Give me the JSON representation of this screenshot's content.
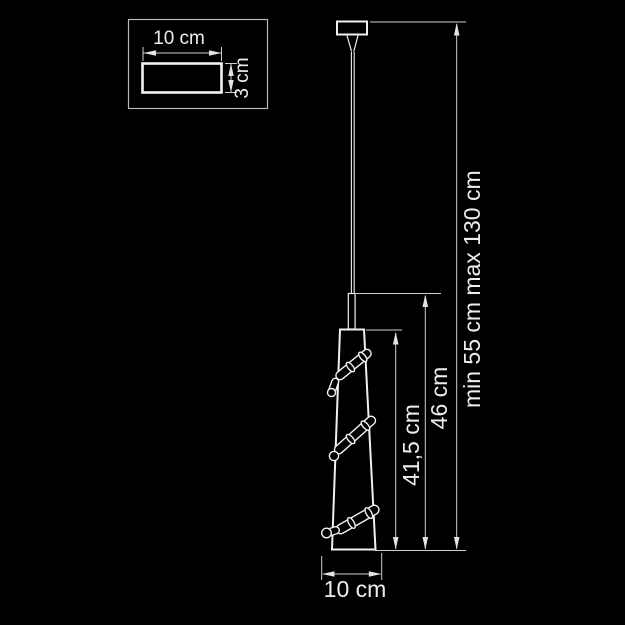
{
  "inset": {
    "width_label": "10 cm",
    "height_label": "3 cm"
  },
  "dimensions": {
    "shade_height": "41,5 cm",
    "total_shade_height": "46 cm",
    "min_suspension": "min 55 cm",
    "max_suspension": "max 130 cm",
    "diameter": "10 cm"
  },
  "colors": {
    "background": "#000000",
    "outline": "#f0f0f0",
    "dimension_line": "#cfcfcf",
    "text": "#ededed"
  }
}
